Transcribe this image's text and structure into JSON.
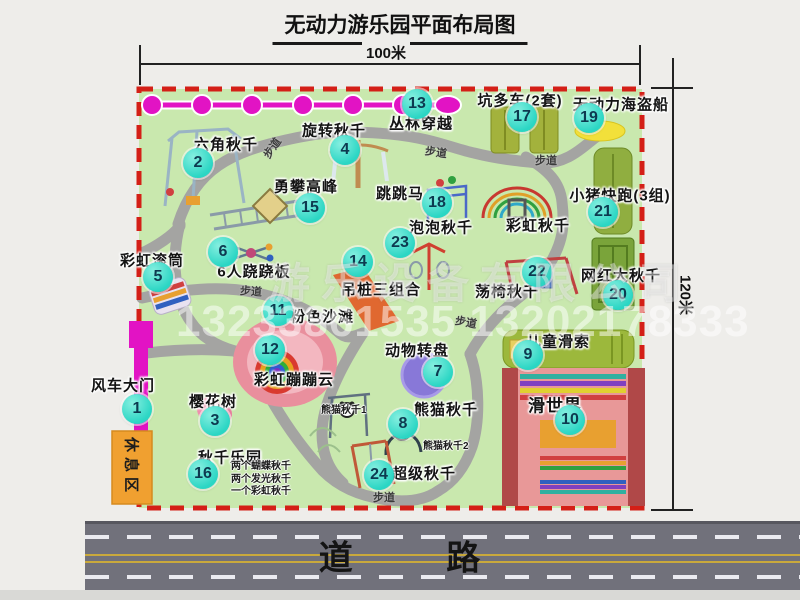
{
  "page": {
    "title": "无动力游乐园平面布局图"
  },
  "dimensions": {
    "top": "100米",
    "right": "120米"
  },
  "road": {
    "label": "道 路"
  },
  "watermark": {
    "company": "游乐设备有限公司",
    "phone": "13233861535 13202178333"
  },
  "rest_area": {
    "label": "休息区"
  },
  "walkway_label": "步道",
  "walkway_label_positions": [
    {
      "x": 272,
      "y": 148,
      "rot": -55
    },
    {
      "x": 436,
      "y": 152,
      "rot": 8
    },
    {
      "x": 546,
      "y": 160,
      "rot": 0
    },
    {
      "x": 251,
      "y": 291,
      "rot": 4
    },
    {
      "x": 466,
      "y": 322,
      "rot": 10
    },
    {
      "x": 384,
      "y": 497,
      "rot": 0
    }
  ],
  "attractions": [
    {
      "num": "1",
      "label": "风车大门",
      "lx": 123,
      "ly": 385,
      "bx": 137,
      "by": 409
    },
    {
      "num": "2",
      "label": "六角秋千",
      "lx": 226,
      "ly": 144,
      "bx": 198,
      "by": 163
    },
    {
      "num": "3",
      "label": "樱花树",
      "lx": 213,
      "ly": 401,
      "bx": 215,
      "by": 421
    },
    {
      "num": "4",
      "label": "旋转秋千",
      "lx": 334,
      "ly": 130,
      "bx": 345,
      "by": 150
    },
    {
      "num": "5",
      "label": "彩虹滚筒",
      "lx": 152,
      "ly": 260,
      "bx": 158,
      "by": 277
    },
    {
      "num": "6",
      "label": "6人跷跷板",
      "lx": 254,
      "ly": 271,
      "bx": 223,
      "by": 252
    },
    {
      "num": "7",
      "label": "动物转盘",
      "lx": 417,
      "ly": 350,
      "bx": 438,
      "by": 372
    },
    {
      "num": "8",
      "label": "熊猫秋千",
      "lx": 446,
      "ly": 409,
      "bx": 403,
      "by": 424
    },
    {
      "num": "9",
      "label": "儿童滑索",
      "lx": 558,
      "ly": 341,
      "bx": 528,
      "by": 355
    },
    {
      "num": "10",
      "label": "滑世界",
      "lx": 555,
      "ly": 404,
      "bx": 570,
      "by": 420,
      "size": 17
    },
    {
      "num": "11",
      "label": "粉色沙滩",
      "lx": 322,
      "ly": 316,
      "bx": 278,
      "by": 311
    },
    {
      "num": "12",
      "label": "彩虹蹦蹦云",
      "lx": 294,
      "ly": 379,
      "bx": 270,
      "by": 350
    },
    {
      "num": "13",
      "label": "丛林穿越",
      "lx": 421,
      "ly": 123,
      "bx": 417,
      "by": 104
    },
    {
      "num": "14",
      "label": "吊桩三组合",
      "lx": 381,
      "ly": 289,
      "bx": 358,
      "by": 262
    },
    {
      "num": "15",
      "label": "勇攀高峰",
      "lx": 306,
      "ly": 186,
      "bx": 310,
      "by": 208
    },
    {
      "num": "16",
      "label": "秋千乐园",
      "lx": 230,
      "ly": 457,
      "bx": 203,
      "by": 474,
      "notes": [
        "两个蝴蝶秋千",
        "两个发光秋千",
        "一个彩虹秋千"
      ],
      "nx": 231,
      "ny": 461
    },
    {
      "num": "17",
      "label": "坑多车(2套)",
      "lx": 520,
      "ly": 100,
      "bx": 522,
      "by": 117
    },
    {
      "num": "18",
      "label": "跳跳马",
      "lx": 400,
      "ly": 193,
      "bx": 437,
      "by": 203
    },
    {
      "num": "19",
      "label": "无动力海盗船",
      "lx": 621,
      "ly": 104,
      "bx": 589,
      "by": 118
    },
    {
      "num": "20",
      "label": "网红大秋千",
      "lx": 621,
      "ly": 275,
      "bx": 618,
      "by": 295
    },
    {
      "num": "21",
      "label": "小猪快跑(3组)",
      "lx": 620,
      "ly": 195,
      "bx": 603,
      "by": 212
    },
    {
      "num": "22",
      "label": "荡椅秋千",
      "lx": 507,
      "ly": 291,
      "bx": 537,
      "by": 272
    },
    {
      "num": "23",
      "label": "泡泡秋千",
      "lx": 441,
      "ly": 227,
      "bx": 400,
      "by": 243
    },
    {
      "num": "24",
      "label": "超级秋千",
      "lx": 424,
      "ly": 473,
      "bx": 379,
      "by": 475
    },
    {
      "label": "彩虹秋千",
      "lx": 538,
      "ly": 225
    }
  ],
  "sub_labels": [
    {
      "text": "熊猫秋千1",
      "x": 345,
      "y": 411
    },
    {
      "text": "熊猫秋千2",
      "x": 447,
      "y": 447
    }
  ],
  "colors": {
    "ground": "#c9e8ae",
    "border_dash": "#d41f17",
    "walkway": "#a4a4a2",
    "badge": "#2bd6c4",
    "zipline": "#e213c4",
    "road": "#71717b",
    "rest_area": "#f0a030"
  }
}
